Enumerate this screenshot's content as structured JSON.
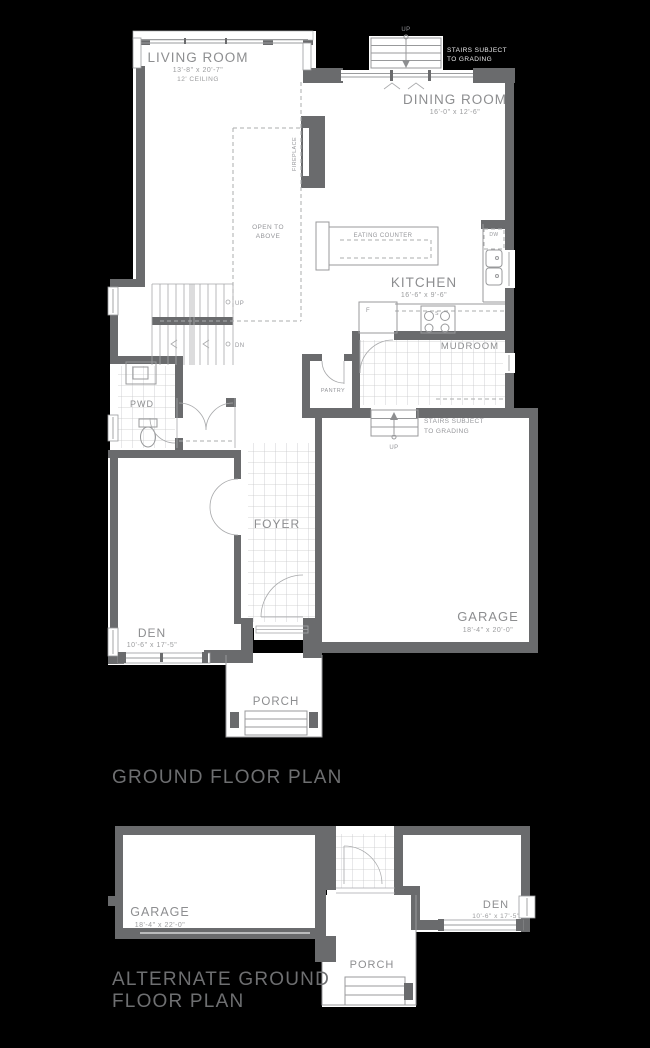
{
  "titles": {
    "ground": "GROUND FLOOR PLAN",
    "alternate_line1": "ALTERNATE GROUND",
    "alternate_line2": "FLOOR PLAN"
  },
  "colors": {
    "background": "#000000",
    "wall": "#6a6b6d",
    "floor": "#ffffff",
    "line": "#98999b",
    "tile_line": "#c6c7c9",
    "label_text": "#8d8e90",
    "title_text": "#6e6f71",
    "white_text": "#e9e9ea"
  },
  "ground_floor": {
    "living_room": {
      "name": "LIVING ROOM",
      "dims": "13'-8\" x 20'-7\"",
      "note": "12' CEILING"
    },
    "dining_room": {
      "name": "DINING ROOM",
      "dims": "16'-0\" x 12'-6\""
    },
    "kitchen": {
      "name": "KITCHEN",
      "dims": "16'-6\" x 9'-6\""
    },
    "eating_counter": {
      "label": "EATING COUNTER"
    },
    "fireplace": {
      "label": "FIREPLACE"
    },
    "open_to_above": {
      "line1": "OPEN TO",
      "line2": "ABOVE"
    },
    "mudroom": {
      "name": "MUDROOM"
    },
    "pantry": {
      "name": "PANTRY"
    },
    "pwd": {
      "name": "PWD"
    },
    "foyer": {
      "name": "FOYER"
    },
    "den": {
      "name": "DEN",
      "dims": "10'-6\" x 17'-5\""
    },
    "garage": {
      "name": "GARAGE",
      "dims": "18'-4\" x 20'-0\""
    },
    "porch": {
      "name": "PORCH"
    },
    "stairs_top": {
      "up": "UP",
      "note1": "STAIRS SUBJECT",
      "note2": "TO GRADING"
    },
    "stairs_mud": {
      "up": "UP",
      "note1": "STAIRS SUBJECT",
      "note2": "TO GRADING"
    },
    "stairs_interior": {
      "up": "UP",
      "dn": "DN"
    },
    "appliances": {
      "dw": "DW",
      "fridge": "F",
      "stove": "S"
    }
  },
  "alternate_floor": {
    "garage": {
      "name": "GARAGE",
      "dims": "18'-4\" x 22'-0\""
    },
    "den": {
      "name": "DEN",
      "dims": "10'-6\" x 17'-5\""
    },
    "porch": {
      "name": "PORCH"
    }
  }
}
